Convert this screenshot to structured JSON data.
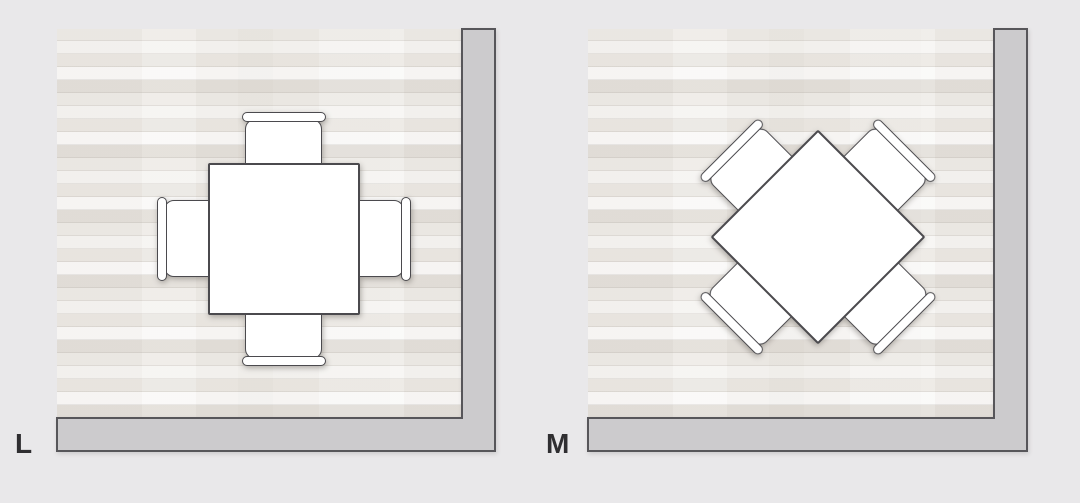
{
  "page": {
    "background": "#e9e8ea"
  },
  "theme": {
    "page_bg": "#e9e8ea",
    "floor_base": "#efedea",
    "wall_fill": "#cccbcd",
    "wall_outline": "#57565a",
    "furniture_fill": "#ffffff",
    "furniture_outline": "#4b4a4e",
    "label_color": "#2f2e31"
  },
  "panels": [
    {
      "label": "L",
      "scene": {
        "table_shape": "square",
        "table_rotation_deg": 0,
        "chair_count": 4,
        "chair_positions": [
          "north",
          "east",
          "south",
          "west"
        ]
      }
    },
    {
      "label": "M",
      "scene": {
        "table_shape": "square",
        "table_rotation_deg": 45,
        "chair_count": 4,
        "chair_positions": [
          "north-west",
          "north-east",
          "south-east",
          "south-west"
        ]
      }
    }
  ]
}
